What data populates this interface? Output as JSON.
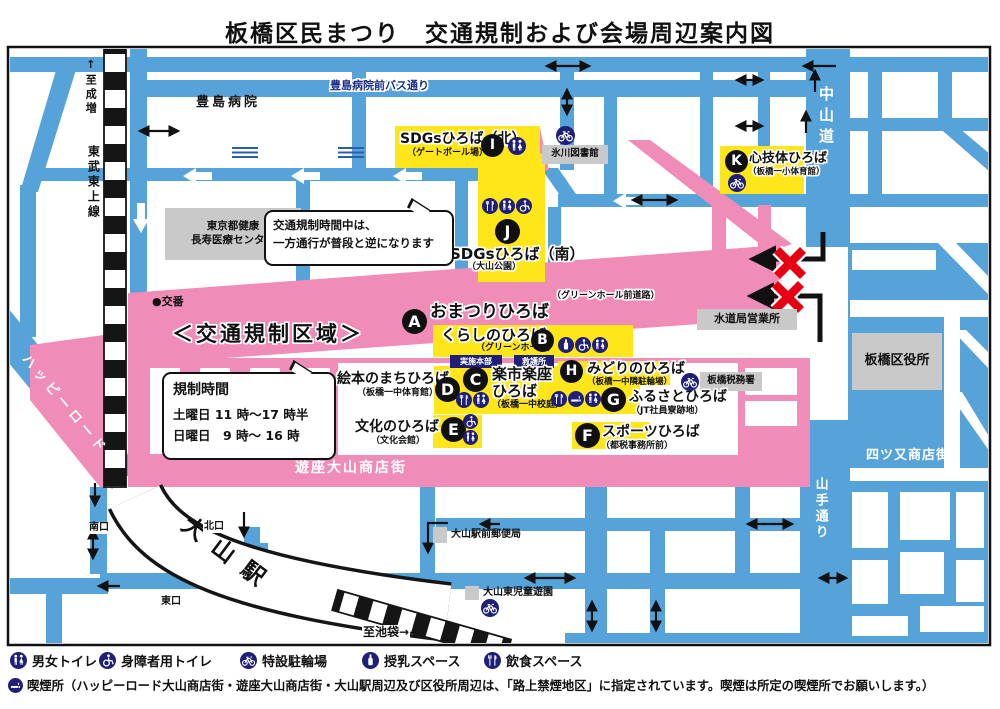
{
  "title": "板橋区民まつり　交通規制および会場周辺案内図",
  "colors": {
    "road_blue": "#56a3da",
    "zone_pink": "#f08cb8",
    "venue_yellow": "#ffe61a",
    "icon_navy": "#1f1f78",
    "building_gray": "#c9c9c9",
    "x_red": "#e60012"
  },
  "roads": {
    "toshima_bus_street": "豊島病院前バス通り",
    "nakasendo": "中山道",
    "yamate_dori": "山手通り",
    "happy_road": "ハッピーロード",
    "yotsumata": "四ツ又商店街",
    "yuza_oyama": "遊座大山商店街",
    "tobu_tojo_line": "東武東上線",
    "to_narimasu": "↑至成増",
    "to_ikebukuro": "至池袋→"
  },
  "places": {
    "toshima_hospital": "豊島病院",
    "hikawa_library": "氷川図書館",
    "health_center_line1": "東京都健康",
    "health_center_line2": "長寿医療センター",
    "koban": "●交番",
    "suido_office": "水道局営業所",
    "tax_office": "板橋税務署",
    "ward_office": "板橋区役所",
    "oyama_post_office": "大山駅前郵便局",
    "oyama_higashi_park": "大山東児童遊園",
    "oyama_station": "大山駅",
    "south_exit": "南口",
    "north_exit": "北口",
    "east_exit": "東口"
  },
  "regulation": {
    "zone_label": "＜交通規制区域＞",
    "notice_line1": "交通規制時間中は、",
    "notice_line2": "一方通行が普段と逆になります",
    "time_title": "規制時間",
    "time_sat": "土曜日 11 時〜17 時半",
    "time_sun": "日曜日　9 時〜 16 時"
  },
  "hq": {
    "honbu": "実施本部",
    "kyugo": "救護所"
  },
  "venues": [
    {
      "letter": "A",
      "name": "おまつりひろば",
      "subtitle": "（グリーンホール前道路）"
    },
    {
      "letter": "B",
      "name": "くらしのひろば",
      "subtitle": "（グリーンホール）"
    },
    {
      "letter": "C",
      "name": "楽市楽座ひろば",
      "subtitle": "（板橋一中校庭）"
    },
    {
      "letter": "D",
      "name": "絵本のまちひろば",
      "subtitle": "（板橋一中体育館）"
    },
    {
      "letter": "E",
      "name": "文化のひろば",
      "subtitle": "（文化会館）"
    },
    {
      "letter": "F",
      "name": "スポーツひろば",
      "subtitle": "（都税事務所前）"
    },
    {
      "letter": "G",
      "name": "ふるさとひろば",
      "subtitle": "（JT社員寮跡地）"
    },
    {
      "letter": "H",
      "name": "みどりのひろば",
      "subtitle": "（板橋一中隣駐輪場）"
    },
    {
      "letter": "I",
      "name": "SDGsひろば（北）",
      "subtitle": "（ゲートボール場）"
    },
    {
      "letter": "J",
      "name": "SDGsひろば（南）",
      "subtitle": "（大山公園）"
    },
    {
      "letter": "K",
      "name": "心技体ひろば",
      "subtitle": "（板橋一小体育館）"
    }
  ],
  "legend": {
    "items": [
      {
        "icon": "toilet-icon",
        "label": "男女トイレ"
      },
      {
        "icon": "wheelchair-icon",
        "label": "身障者用トイレ"
      },
      {
        "icon": "bicycle-icon",
        "label": "特設駐輪場"
      },
      {
        "icon": "nursing-icon",
        "label": "授乳スペース"
      },
      {
        "icon": "food-icon",
        "label": "飲食スペース"
      }
    ],
    "smoking_note": "喫煙所（ハッピーロード大山商店街・遊座大山商店街・大山駅周辺及び区役所周辺は、「路上禁煙地区」に指定されています。喫煙は所定の喫煙所でお願いします。）"
  }
}
